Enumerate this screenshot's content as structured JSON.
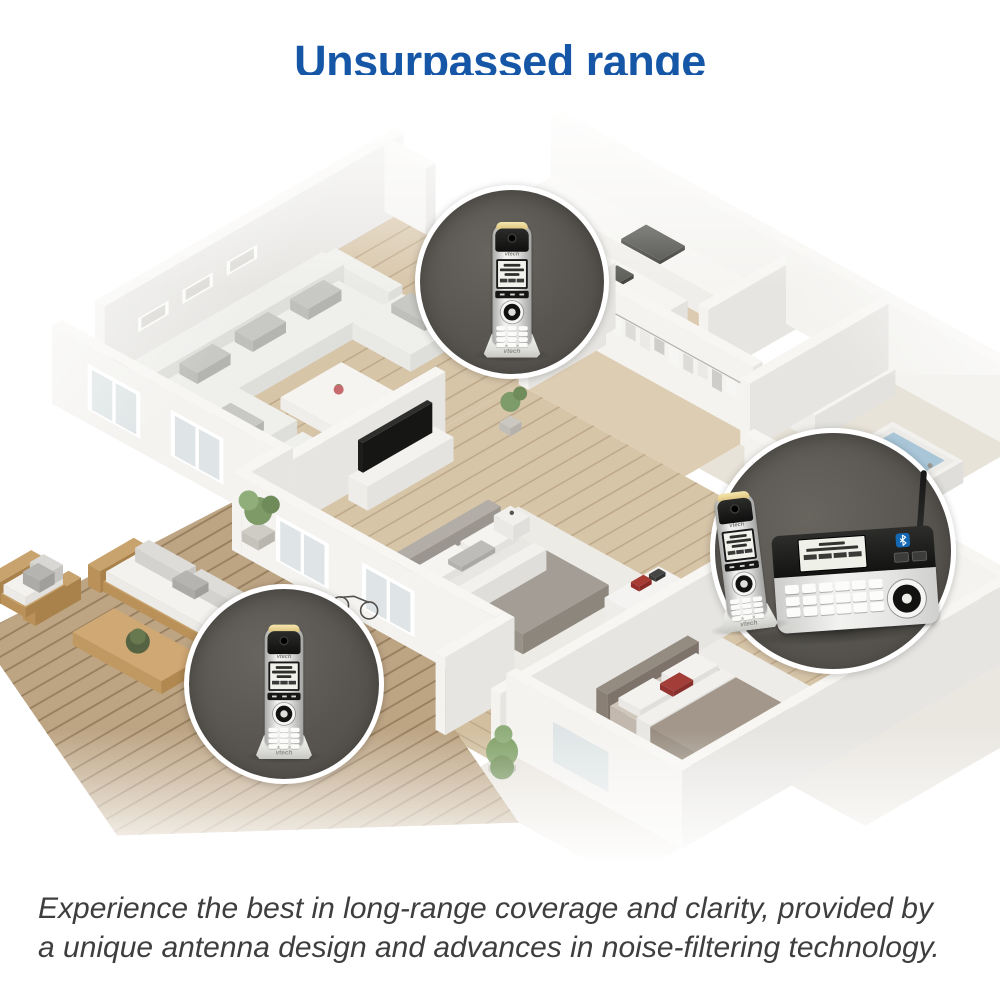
{
  "header": {
    "title": "Unsurpassed range",
    "title_style": "color:#1557a6",
    "accent_color": "#1557a6"
  },
  "caption": {
    "line1": "Experience the best in long-range coverage and clarity, provided by",
    "line2": "a unique antenna design and advances in noise-filtering technology."
  },
  "product": {
    "brand": "vtech",
    "bluetooth_color": "#1569b4"
  },
  "callouts": [
    {
      "name": "living-room-handset",
      "description": "Cordless handset on charging base inside the house"
    },
    {
      "name": "base-station",
      "description": "Main base station with docked handset, answering system display, Bluetooth and long-range antenna"
    },
    {
      "name": "patio-handset",
      "description": "Cordless handset on charging base on the outdoor patio"
    }
  ]
}
